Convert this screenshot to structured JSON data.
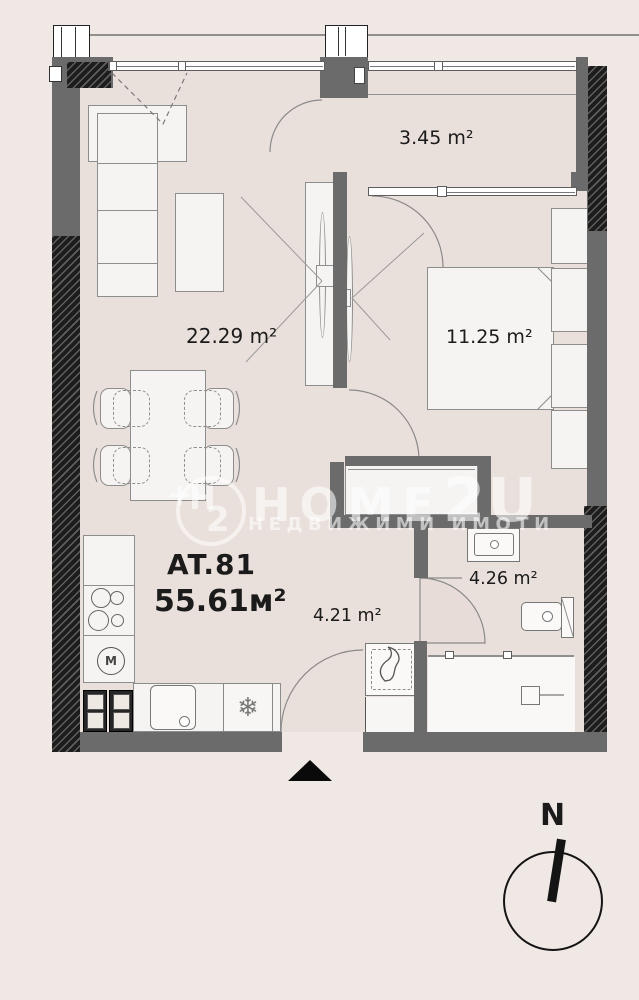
{
  "plan": {
    "apartment": {
      "code": "AT.81",
      "total_area": "55.61м²"
    },
    "rooms": {
      "balcony": {
        "label": "3.45 m²"
      },
      "living": {
        "label": "22.29 m²"
      },
      "bedroom": {
        "label": "11.25 m²"
      },
      "bathroom": {
        "label": "4.26 m²"
      },
      "hallway": {
        "label": "4.21 m²"
      }
    },
    "icons": {
      "fridge_snowflake": "❄",
      "washer_m": "M"
    },
    "compass": {
      "north_label": "N"
    },
    "watermark": {
      "brand_main": "HOME",
      "brand_suffix": "2U",
      "subtitle": "НЕДВИЖИМИ ИМОТИ",
      "logo_plus": "+",
      "logo_h": "H",
      "logo_sub": "2"
    },
    "colors": {
      "background": "#F0E8E4",
      "floor": "#EAE0DB",
      "wall": "#6b6b6b",
      "hatched_wall": "#1d1d1d",
      "text": "#1b1b1b"
    }
  }
}
